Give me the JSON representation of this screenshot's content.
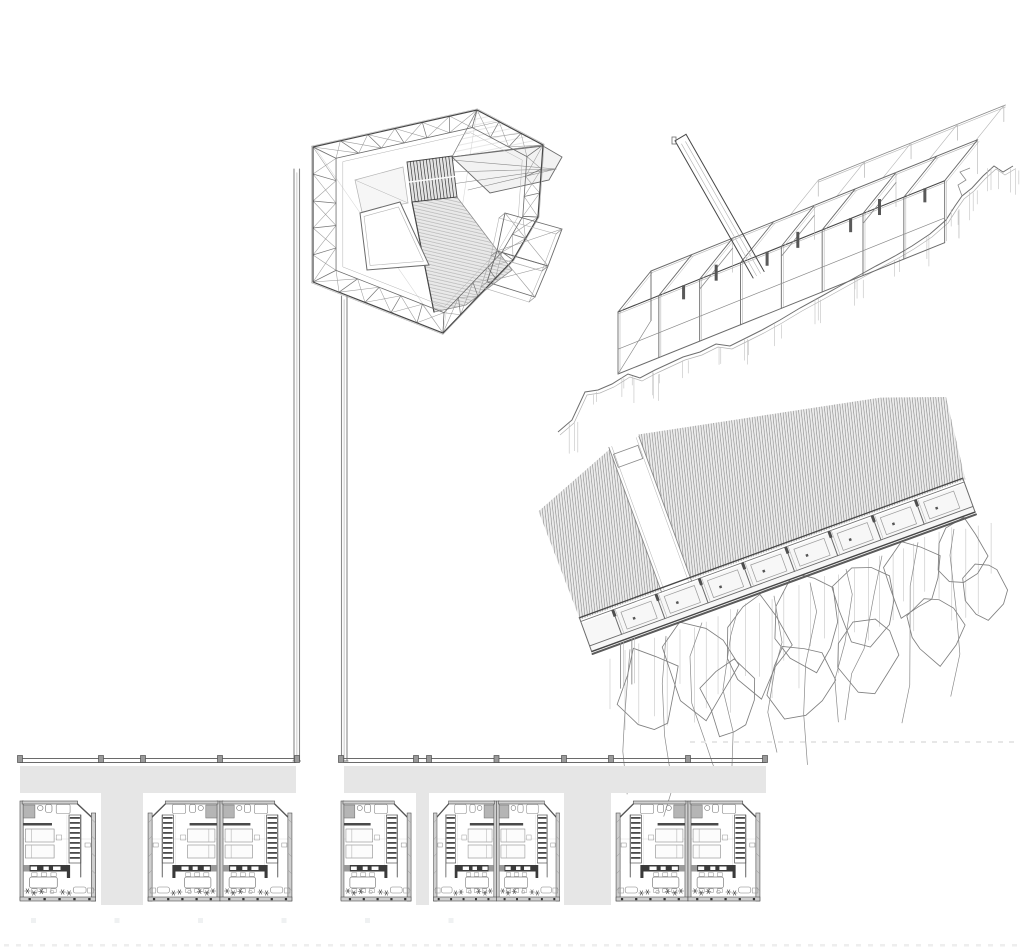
{
  "meta": {
    "type": "architectural-sketch-sheet",
    "description": "pencil drawing: faceted wireframe pavilion, skeletal frame axonometric with ramp, hillside cellular building axonometric, row of repeated apartment floor plans",
    "canvas_w": 1024,
    "canvas_h": 950,
    "background": "#ffffff",
    "visible_text": ""
  },
  "palette": {
    "pencil_dark": "#474747",
    "pencil": "#6b6b6b",
    "pencil_mid": "#8a8a8a",
    "pencil_light": "#b3b3b3",
    "construction": "#d9d9d9",
    "plane_light": "#f2f2f2",
    "plane_mid": "#e9e9e9",
    "hatch_stroke": "#8f8f8f",
    "band_gray": "#e6e6e6",
    "wall_fill": "#cfcfcf",
    "wall_edge": "#4f4f4f",
    "dark_fixture": "#3a3a3a",
    "shower_gray": "#b5b5b5",
    "ghost": "#eeeeee"
  },
  "pavilion": {
    "ring": [
      [
        313,
        147
      ],
      [
        477,
        110
      ],
      [
        543,
        145
      ],
      [
        538,
        217
      ],
      [
        513,
        260
      ],
      [
        443,
        333
      ],
      [
        313,
        282
      ]
    ],
    "inner_lerp": 0.17,
    "louver": [
      [
        407,
        162
      ],
      [
        452,
        156
      ],
      [
        457,
        197
      ],
      [
        412,
        202
      ]
    ],
    "louver_lines": 13,
    "aux_room": [
      [
        355,
        180
      ],
      [
        403,
        167
      ],
      [
        408,
        203
      ],
      [
        362,
        212
      ]
    ],
    "void_triangle": [
      [
        360,
        213
      ],
      [
        400,
        202
      ],
      [
        429,
        265
      ],
      [
        367,
        270
      ]
    ],
    "central_plane": [
      [
        412,
        202
      ],
      [
        457,
        197
      ],
      [
        512,
        270
      ],
      [
        466,
        305
      ],
      [
        434,
        312
      ]
    ],
    "apex_triangle": [
      [
        477,
        110
      ],
      [
        543,
        145
      ],
      [
        452,
        157
      ]
    ],
    "beak": {
      "outline": [
        [
          452,
          157
        ],
        [
          543,
          146
        ],
        [
          562,
          157
        ],
        [
          549,
          180
        ],
        [
          490,
          193
        ]
      ],
      "tip": [
        556,
        169
      ],
      "spokes": [
        [
          452,
          160
        ],
        [
          452,
          172
        ],
        [
          452,
          184
        ],
        [
          468,
          190
        ]
      ]
    },
    "wing_quads": [
      [
        [
          505,
          213
        ],
        [
          562,
          229
        ],
        [
          548,
          266
        ],
        [
          497,
          251
        ]
      ],
      [
        [
          497,
          251
        ],
        [
          548,
          266
        ],
        [
          535,
          297
        ],
        [
          487,
          282
        ]
      ]
    ]
  },
  "pilotis": {
    "gap": 5.5,
    "columns": [
      {
        "x": 294,
        "y1": 169,
        "y2": 761
      },
      {
        "x": 341.5,
        "y1": 296,
        "y2": 761
      }
    ]
  },
  "frame": {
    "origin": [
      618,
      312
    ],
    "dir": [
      0.928,
      -0.373
    ],
    "length": 352,
    "depth": [
      33,
      -41
    ],
    "post_height": 62,
    "bays": 8,
    "mid_rail": 0.6,
    "back_band_from": 150,
    "back_band_mult": 1.85,
    "ramp": {
      "start": [
        678,
        146
      ],
      "dir": [
        0.494,
        0.868
      ],
      "len": 152,
      "width": [
        11,
        -6.5
      ]
    },
    "terrain": [
      [
        558,
        432
      ],
      [
        572,
        420
      ],
      [
        585,
        392
      ],
      [
        598,
        390
      ],
      [
        612,
        384
      ],
      [
        628,
        374
      ],
      [
        640,
        378
      ],
      [
        655,
        370
      ],
      [
        668,
        364
      ],
      [
        683,
        357
      ],
      [
        700,
        352
      ],
      [
        716,
        344
      ],
      [
        730,
        346
      ],
      [
        748,
        337
      ],
      [
        762,
        330
      ],
      [
        780,
        320
      ],
      [
        800,
        308
      ],
      [
        822,
        296
      ],
      [
        840,
        286
      ],
      [
        858,
        276
      ],
      [
        876,
        266
      ],
      [
        895,
        256
      ],
      [
        912,
        246
      ],
      [
        930,
        234
      ],
      [
        946,
        220
      ],
      [
        955,
        206
      ],
      [
        962,
        196
      ],
      [
        972,
        188
      ],
      [
        983,
        176
      ],
      [
        994,
        166
      ],
      [
        1003,
        172
      ],
      [
        1013,
        166
      ]
    ]
  },
  "hillside": {
    "origin": [
      618,
      642
    ],
    "angle_deg": -20,
    "length": 380,
    "wall_depth": 36,
    "cells": 8,
    "cell_start": 6,
    "cell_step": 46,
    "hatch_panel_1": [
      [
        -28,
        -34
      ],
      [
        -30,
        -150
      ],
      [
        58,
        -184
      ],
      [
        58,
        -34
      ]
    ],
    "hatch_panel_2": [
      [
        90,
        -188
      ],
      [
        330,
        -140
      ],
      [
        392,
        -118
      ],
      [
        382,
        -34
      ],
      [
        90,
        -34
      ]
    ],
    "walkway": {
      "x1": 58,
      "x2": 90,
      "y_top": -186,
      "notch": [
        60,
        -178,
        26,
        14
      ]
    },
    "cliff_edge": [
      [
        612,
        650
      ],
      [
        962,
        520
      ]
    ],
    "cliff_blobs": [
      [
        650,
        690,
        30,
        42
      ],
      [
        700,
        665,
        34,
        48
      ],
      [
        755,
        645,
        30,
        44
      ],
      [
        810,
        622,
        34,
        46
      ],
      [
        865,
        600,
        30,
        40
      ],
      [
        915,
        578,
        28,
        38
      ],
      [
        960,
        556,
        24,
        34
      ],
      [
        730,
        700,
        26,
        34
      ],
      [
        800,
        680,
        30,
        38
      ],
      [
        870,
        655,
        28,
        36
      ],
      [
        935,
        625,
        26,
        34
      ],
      [
        985,
        590,
        20,
        28
      ]
    ],
    "striation_range": [
      610,
      1005
    ],
    "ground_dashes_y": 741
  },
  "floor_plans": {
    "line_y": 760,
    "band_top": 766,
    "band_bottom": 793,
    "unit_top": 793,
    "unit_height": 110,
    "line_segments": [
      [
        20,
        296
      ],
      [
        344,
        766
      ]
    ],
    "street_gap": [
      296,
      344
    ],
    "groups": [
      {
        "x": 20,
        "w": 81,
        "type": "single"
      },
      {
        "x": 143,
        "w": 154,
        "type": "pair"
      },
      {
        "x": 341,
        "w": 75,
        "type": "single"
      },
      {
        "x": 429,
        "w": 135,
        "type": "pair"
      },
      {
        "x": 611,
        "w": 154,
        "type": "pair"
      }
    ],
    "separators": [
      [
        101,
        143
      ],
      [
        416,
        429
      ],
      [
        564,
        611
      ]
    ],
    "unit_w": 76
  },
  "ghost_marks": {
    "squares": {
      "y": 918,
      "start_x": 31,
      "step": 83.5,
      "count": 6,
      "size": 5
    },
    "dashes": {
      "y": 944,
      "x1": 4,
      "x2": 1020,
      "step": 12,
      "w": 5,
      "h": 2.5
    }
  }
}
